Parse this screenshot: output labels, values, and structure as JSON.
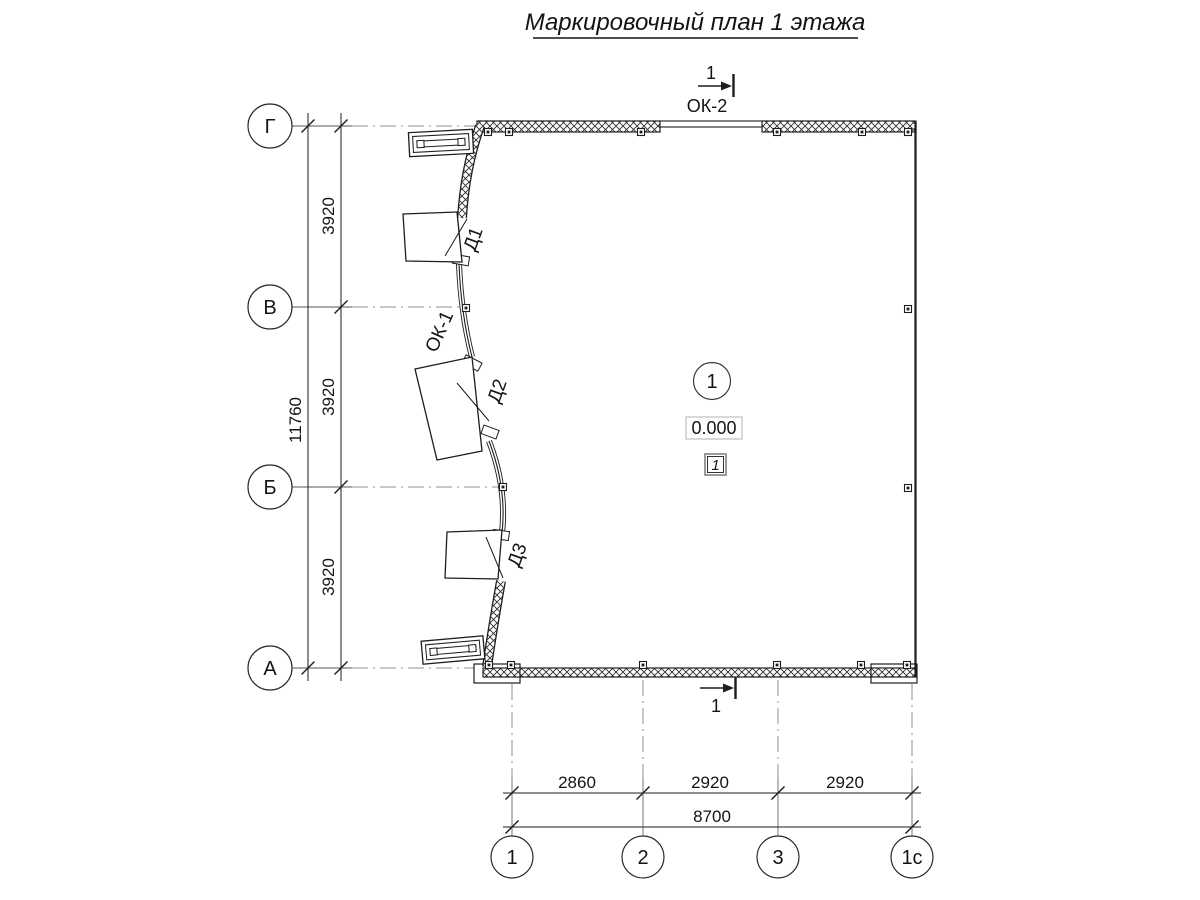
{
  "title": "Маркировочный план 1 этажа",
  "section_marks": {
    "top_number": "1",
    "bottom_number": "1"
  },
  "windows": {
    "ok1": "ОК-1",
    "ok2": "ОК-2"
  },
  "doors": [
    "Д1",
    "Д2",
    "Д3"
  ],
  "axes": {
    "left": [
      "Г",
      "В",
      "Б",
      "А"
    ],
    "bottom": [
      "1",
      "2",
      "3",
      "1с"
    ]
  },
  "dimensions": {
    "left_segments": [
      "3920",
      "3920",
      "3920"
    ],
    "left_total": "11760",
    "bottom_segments": [
      "2860",
      "2920",
      "2920"
    ],
    "bottom_total": "8700"
  },
  "room": {
    "number": "1",
    "elevation": "0.000",
    "floor_type": "1"
  },
  "colors": {
    "line": "#1d1d1d",
    "axis_line": "#8f8f8f",
    "elevation_border": "#bfbfbf",
    "floor_box_border": "#909090"
  }
}
